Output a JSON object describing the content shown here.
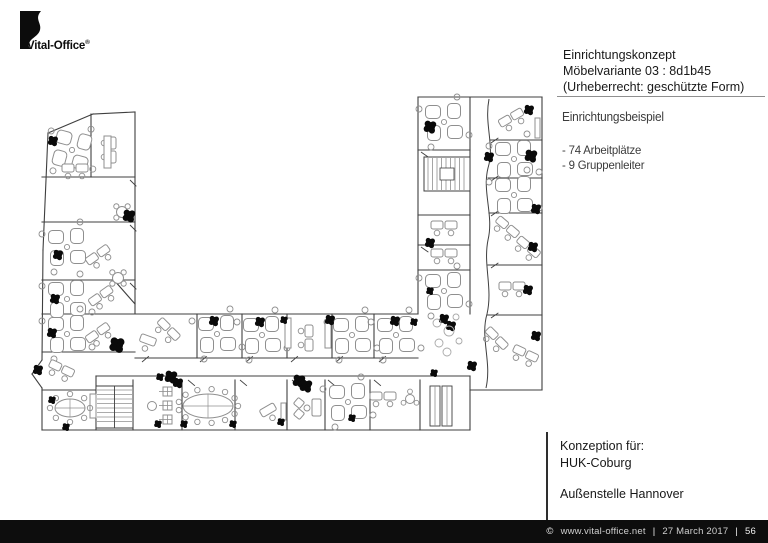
{
  "logo": {
    "brand": "Vital-Office",
    "registered": "®"
  },
  "header_block": {
    "line1": "Einrichtungskonzept",
    "line2": "Möbelvariante 03 : 8d1b45",
    "line3": "(Urheberrecht: geschützte Form)"
  },
  "concept_block": {
    "title": "Einrichtungsbeispiel",
    "item1": "- 74 Arbeitplätze",
    "item2": "- 9 Gruppenleiter"
  },
  "client_block": {
    "label": "Konzeption für:",
    "client": "HUK-Coburg",
    "site": "Außenstelle Hannover"
  },
  "footer": {
    "copyright": "©",
    "url": "www.vital-office.net",
    "sep1": "|",
    "date": "27 March 2017",
    "sep2": "|",
    "page_number": "56",
    "bar_color": "#0d0d0d"
  },
  "plan": {
    "wall_color": "#3f3f3f",
    "furniture_color": "#8f8f8f",
    "plant_color": "#0a0a0a",
    "pebble_color": "#a8a8a8",
    "walls": [
      [
        48,
        133,
        93,
        114
      ],
      [
        93,
        114,
        135,
        112
      ],
      [
        135,
        112,
        135,
        314
      ],
      [
        48,
        133,
        43,
        250
      ],
      [
        43,
        250,
        42,
        360
      ],
      [
        42,
        360,
        32,
        374
      ],
      [
        32,
        374,
        42,
        388
      ],
      [
        42,
        388,
        42,
        430
      ],
      [
        42,
        430,
        470,
        430
      ],
      [
        470,
        430,
        470,
        376
      ],
      [
        470,
        390,
        542,
        390
      ],
      [
        542,
        390,
        542,
        97
      ],
      [
        542,
        97,
        418,
        97
      ],
      [
        418,
        97,
        418,
        314
      ],
      [
        42,
        314,
        418,
        314
      ],
      [
        42,
        177,
        135,
        177
      ],
      [
        42,
        222,
        135,
        222
      ],
      [
        42,
        280,
        135,
        280
      ],
      [
        114,
        280,
        135,
        304
      ],
      [
        42,
        352,
        135,
        352
      ],
      [
        42,
        390,
        96,
        390
      ],
      [
        91,
        114,
        91,
        177
      ],
      [
        135,
        358,
        418,
        358
      ],
      [
        96,
        376,
        470,
        376
      ],
      [
        197,
        314,
        197,
        358
      ],
      [
        242,
        314,
        242,
        358
      ],
      [
        287,
        314,
        287,
        358
      ],
      [
        332,
        314,
        332,
        358
      ],
      [
        374,
        314,
        374,
        358
      ],
      [
        96,
        376,
        96,
        430
      ],
      [
        133,
        380,
        133,
        430
      ],
      [
        182,
        380,
        182,
        430
      ],
      [
        235,
        380,
        235,
        430
      ],
      [
        287,
        380,
        287,
        430
      ],
      [
        325,
        380,
        325,
        430
      ],
      [
        370,
        380,
        370,
        430
      ],
      [
        420,
        380,
        420,
        430
      ],
      [
        418,
        150,
        470,
        150
      ],
      [
        418,
        215,
        470,
        215
      ],
      [
        418,
        245,
        470,
        245
      ],
      [
        418,
        270,
        470,
        270
      ],
      [
        470,
        97,
        470,
        314
      ],
      [
        490,
        140,
        542,
        140
      ],
      [
        488,
        178,
        542,
        178
      ],
      [
        489,
        213,
        542,
        213
      ],
      [
        488,
        265,
        542,
        265
      ],
      [
        487,
        315,
        542,
        315
      ]
    ],
    "wavy_wall": "M489,99 C484,125 495,145 488,168 C482,192 494,215 488,240 C483,265 493,288 487,314 C480,338 492,362 486,388",
    "clusters": [
      [
        72,
        150,
        15
      ],
      [
        67,
        247,
        0
      ],
      [
        67,
        299,
        0
      ],
      [
        67,
        334,
        0
      ],
      [
        217,
        334,
        0
      ],
      [
        262,
        335,
        0
      ],
      [
        352,
        335,
        0
      ],
      [
        396,
        335,
        0
      ],
      [
        348,
        402,
        0
      ],
      [
        444,
        122,
        0
      ],
      [
        444,
        291,
        0
      ],
      [
        514,
        159,
        0
      ],
      [
        514,
        195,
        0
      ]
    ],
    "duos": [
      [
        75,
        172,
        0
      ],
      [
        108,
        150,
        90
      ],
      [
        100,
        258,
        -35
      ],
      [
        103,
        299,
        -35
      ],
      [
        100,
        336,
        -35
      ],
      [
        60,
        372,
        25
      ],
      [
        166,
        332,
        45
      ],
      [
        305,
        338,
        90
      ],
      [
        383,
        400,
        0
      ],
      [
        444,
        229,
        0
      ],
      [
        444,
        257,
        0
      ],
      [
        513,
        121,
        -30
      ],
      [
        505,
        230,
        40
      ],
      [
        526,
        250,
        40
      ],
      [
        512,
        290,
        0
      ],
      [
        494,
        341,
        45
      ],
      [
        524,
        357,
        25
      ]
    ],
    "singles": [
      [
        148,
        340,
        20
      ],
      [
        268,
        410,
        -30
      ]
    ],
    "cabinets": [
      [
        104,
        136,
        7,
        32
      ],
      [
        285,
        318,
        6,
        30
      ],
      [
        325,
        320,
        6,
        28
      ],
      [
        90,
        394,
        6,
        24
      ],
      [
        281,
        403,
        5,
        17
      ],
      [
        535,
        118,
        5,
        20
      ]
    ],
    "lockers": [
      [
        430,
        386,
        10,
        40
      ],
      [
        442,
        386,
        10,
        40
      ]
    ],
    "round_tables": [
      [
        122,
        212
      ],
      [
        118,
        278
      ]
    ],
    "small_tables": [
      [
        152,
        406,
        0
      ],
      [
        410,
        399,
        3
      ]
    ],
    "ovals": [
      {
        "cx": 208,
        "cy": 406,
        "rx": 25,
        "ry": 12,
        "chairs": 13
      },
      {
        "cx": 70,
        "cy": 408,
        "rx": 15,
        "ry": 9,
        "chairs": 8
      }
    ],
    "sofa": {
      "chairs": [
        [
          299,
          403
        ],
        [
          299,
          414
        ]
      ],
      "table": [
        307,
        408
      ],
      "couch": [
        312,
        399,
        9,
        17
      ]
    },
    "racks": [
      [
        163,
        387
      ],
      [
        163,
        401
      ],
      [
        163,
        415
      ]
    ],
    "stairs": [
      {
        "x": 96,
        "y": 386,
        "w": 37,
        "h": 42,
        "dir": "h"
      },
      {
        "x": 424,
        "y": 157,
        "w": 46,
        "h": 34,
        "dir": "v"
      }
    ],
    "plants": [
      [
        53,
        141,
        4
      ],
      [
        58,
        255,
        4
      ],
      [
        55,
        299,
        4
      ],
      [
        52,
        333,
        4
      ],
      [
        38,
        370,
        4
      ],
      [
        52,
        400,
        3
      ],
      [
        66,
        427,
        3
      ],
      [
        129,
        216,
        5
      ],
      [
        117,
        345,
        6
      ],
      [
        160,
        377,
        3
      ],
      [
        171,
        377,
        5
      ],
      [
        178,
        383,
        4
      ],
      [
        214,
        321,
        4
      ],
      [
        260,
        322,
        4
      ],
      [
        284,
        320,
        3
      ],
      [
        330,
        320,
        4
      ],
      [
        395,
        321,
        4
      ],
      [
        414,
        322,
        3
      ],
      [
        444,
        319,
        4
      ],
      [
        451,
        326,
        4
      ],
      [
        158,
        424,
        3
      ],
      [
        184,
        424,
        3
      ],
      [
        233,
        424,
        3
      ],
      [
        281,
        422,
        3
      ],
      [
        299,
        381,
        5
      ],
      [
        306,
        386,
        5
      ],
      [
        352,
        418,
        3
      ],
      [
        430,
        127,
        5
      ],
      [
        529,
        110,
        4
      ],
      [
        489,
        157,
        4
      ],
      [
        531,
        156,
        5
      ],
      [
        536,
        209,
        4
      ],
      [
        533,
        247,
        4
      ],
      [
        430,
        243,
        4
      ],
      [
        430,
        291,
        3
      ],
      [
        528,
        290,
        4
      ],
      [
        536,
        336,
        4
      ],
      [
        472,
        366,
        4
      ],
      [
        434,
        373,
        3
      ]
    ],
    "pebbles": [
      [
        437,
        323,
        4
      ],
      [
        449,
        331,
        5
      ],
      [
        439,
        343,
        4
      ],
      [
        456,
        317,
        3
      ],
      [
        447,
        352,
        4
      ],
      [
        459,
        341,
        3
      ]
    ],
    "doors": [
      [
        142,
        362,
        -40
      ],
      [
        200,
        362,
        -40
      ],
      [
        246,
        362,
        -40
      ],
      [
        291,
        362,
        -40
      ],
      [
        336,
        362,
        -40
      ],
      [
        379,
        362,
        -40
      ],
      [
        188,
        380,
        40
      ],
      [
        240,
        380,
        40
      ],
      [
        292,
        380,
        40
      ],
      [
        328,
        380,
        40
      ],
      [
        374,
        380,
        40
      ],
      [
        130,
        180,
        45
      ],
      [
        130,
        225,
        45
      ],
      [
        130,
        283,
        45
      ],
      [
        421,
        152,
        35
      ],
      [
        421,
        247,
        35
      ],
      [
        491,
        143,
        -35
      ],
      [
        491,
        181,
        -35
      ],
      [
        491,
        216,
        -35
      ],
      [
        491,
        268,
        -35
      ],
      [
        491,
        318,
        -35
      ]
    ]
  }
}
